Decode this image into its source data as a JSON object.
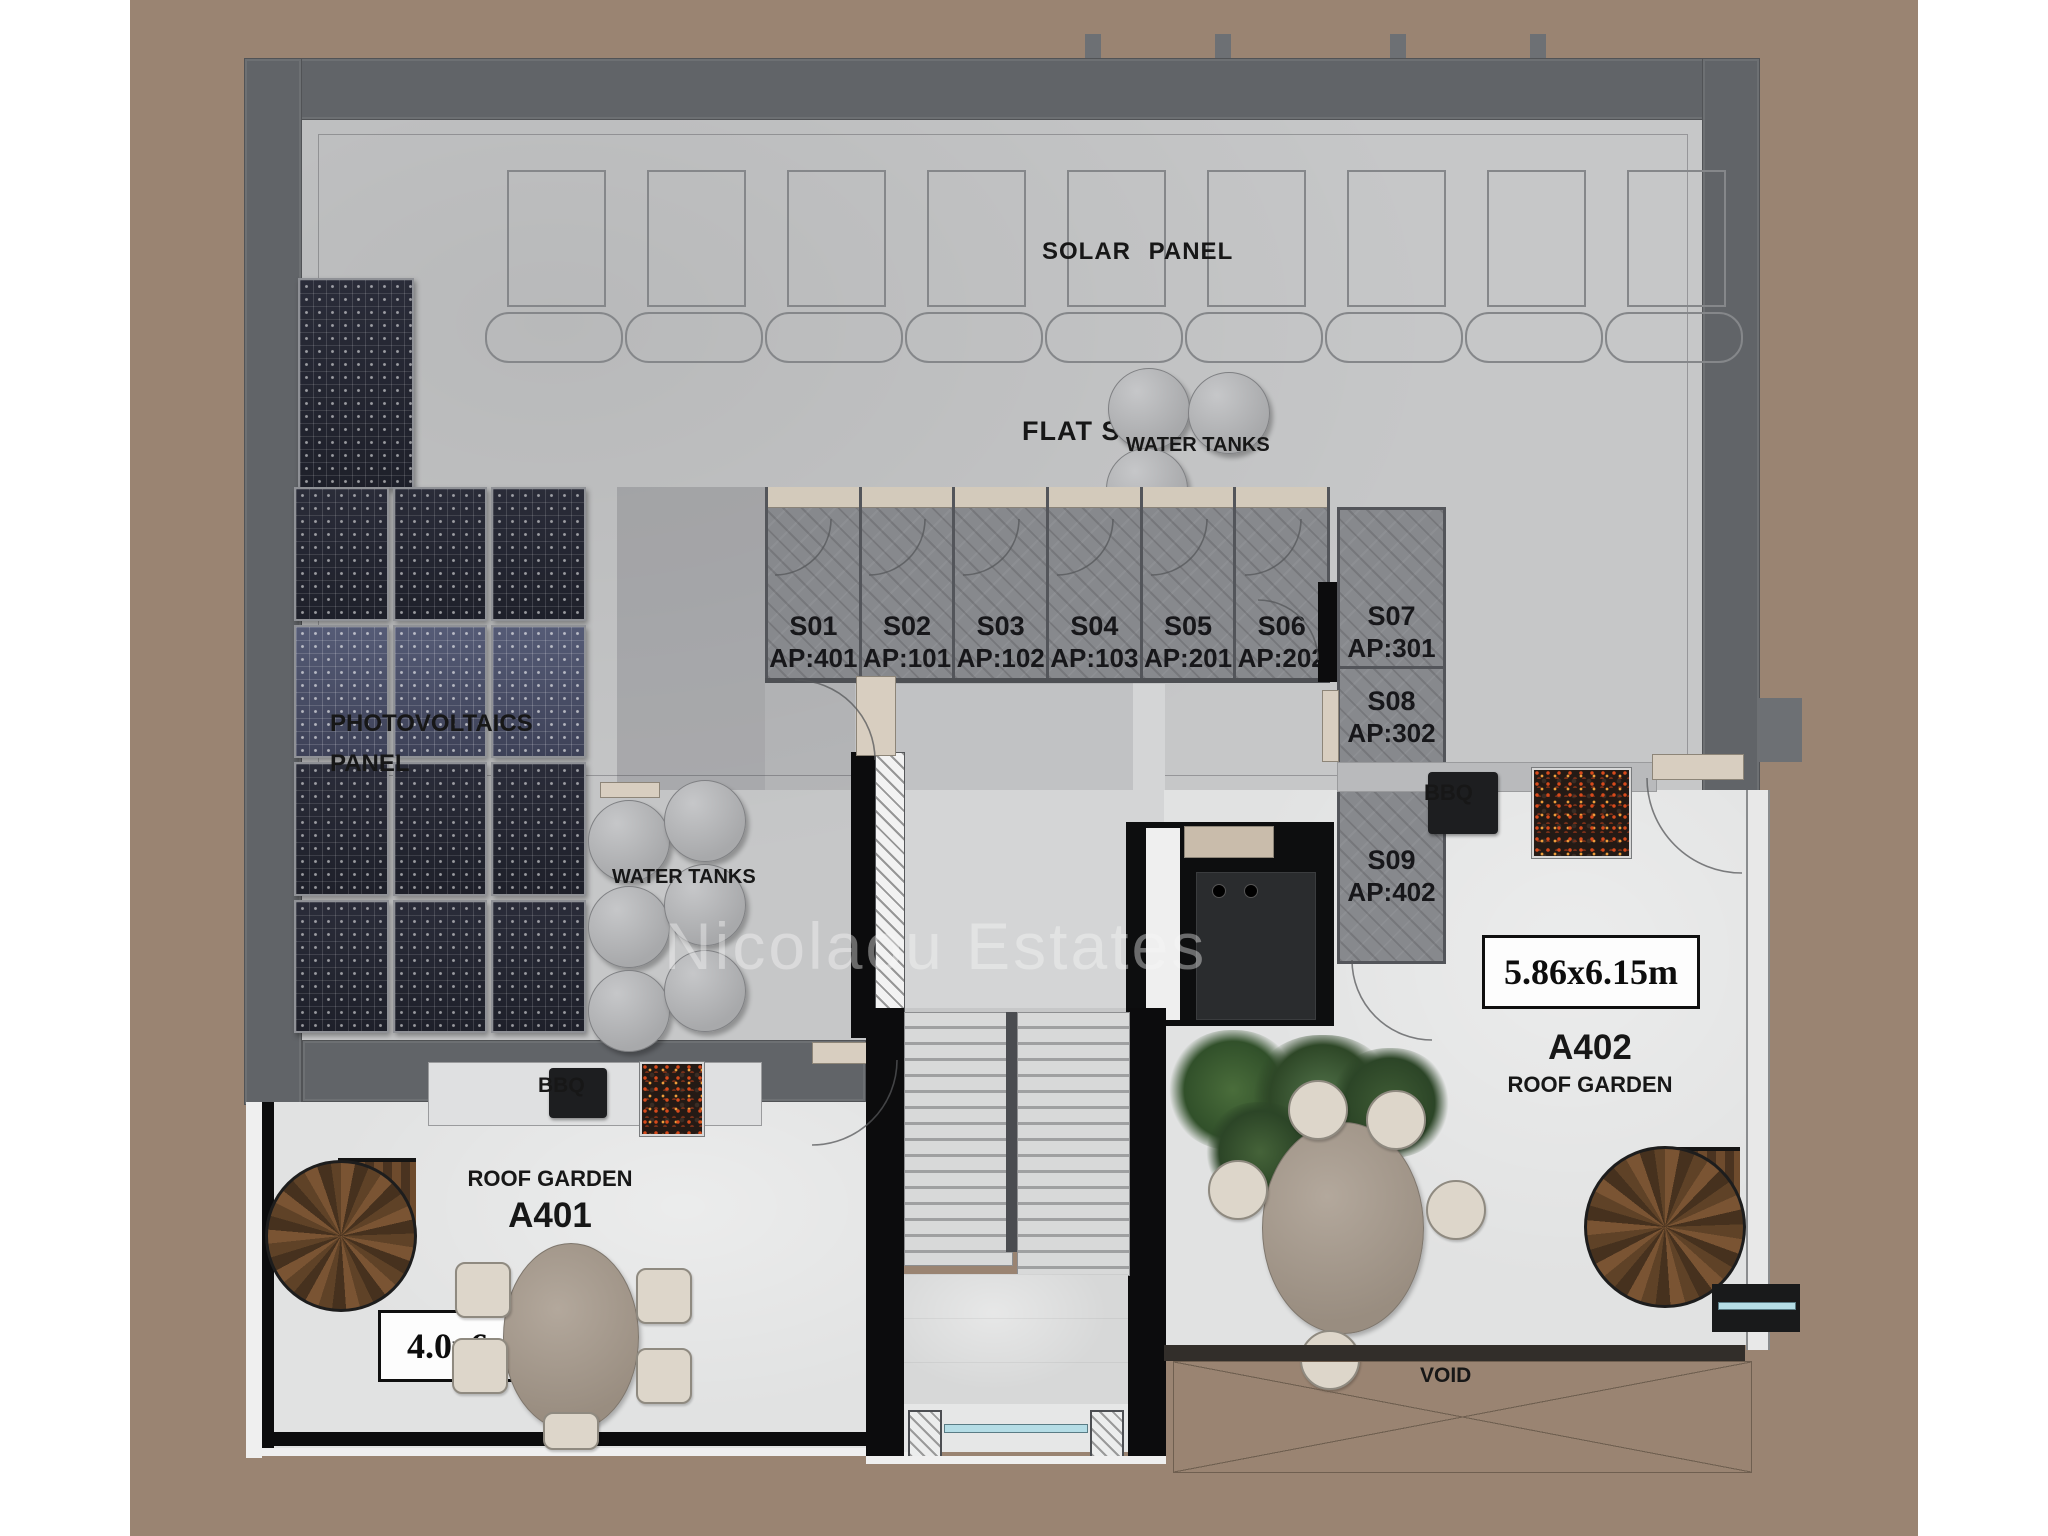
{
  "plan": {
    "watermark": "Nicolaou Estates",
    "area_labels": {
      "solar_panel": "SOLAR PANEL",
      "flat_slab": "FLAT SLAB",
      "photovoltaics_line1": "PHOTOVOLTAICS",
      "photovoltaics_line2": "PANEL",
      "water_tanks_left": "WATER TANKS",
      "water_tanks_right": "WATER TANKS",
      "void": "VOID"
    },
    "equipment": {
      "bbq_left": "BBQ",
      "bbq_right": "BBQ"
    },
    "storage_units": [
      {
        "code": "S01",
        "ap": "AP:401"
      },
      {
        "code": "S02",
        "ap": "AP:101"
      },
      {
        "code": "S03",
        "ap": "AP:102"
      },
      {
        "code": "S04",
        "ap": "AP:103"
      },
      {
        "code": "S05",
        "ap": "AP:201"
      },
      {
        "code": "S06",
        "ap": "AP:202"
      },
      {
        "code": "S07",
        "ap": "AP:301"
      },
      {
        "code": "S08",
        "ap": "AP:302"
      },
      {
        "code": "S09",
        "ap": "AP:402"
      }
    ],
    "gardens": [
      {
        "code": "A401",
        "label": "ROOF GARDEN",
        "dimensions": "4.0x6.40m"
      },
      {
        "code": "A402",
        "label": "ROOF GARDEN",
        "dimensions": "5.86x6.15m"
      }
    ],
    "colors": {
      "background": "#9a8472",
      "slab": "#c6c7c8",
      "wall": "#616468",
      "garden_floor": "#e1e2e2",
      "pv_panel": "#23242e",
      "wood": "#5f4227"
    }
  }
}
